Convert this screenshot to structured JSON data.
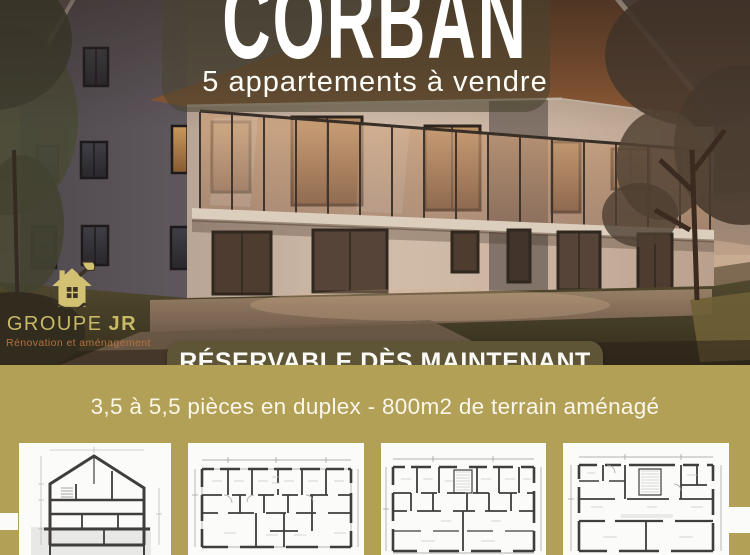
{
  "poster": {
    "title": "CORBAN",
    "subtitle": "5 appartements à vendre",
    "banner_label": "RÉSERVABLE DÈS MAINTENANT",
    "details_line": "3,5 à 5,5 pièces en duplex - 800m2 de terrain aménagé"
  },
  "logo": {
    "name_main": "GROUPE",
    "name_suffix": "JR",
    "tagline": "Rénovation et aménagement"
  },
  "colors": {
    "gold_background": "#b1a055",
    "banner_olive": "#5d5535",
    "title_overlay_olive": "rgba(72,68,46,0.58)",
    "logo_gold": "#c9b967",
    "logo_tagline_rust": "#b5713f",
    "card_white": "#fbfbfa",
    "plan_wall_gray": "#3f3e3c"
  },
  "plans": [
    {
      "name": "building-cross-section"
    },
    {
      "name": "floor-plan-upper"
    },
    {
      "name": "floor-plan-middle"
    },
    {
      "name": "floor-plan-ground"
    }
  ]
}
